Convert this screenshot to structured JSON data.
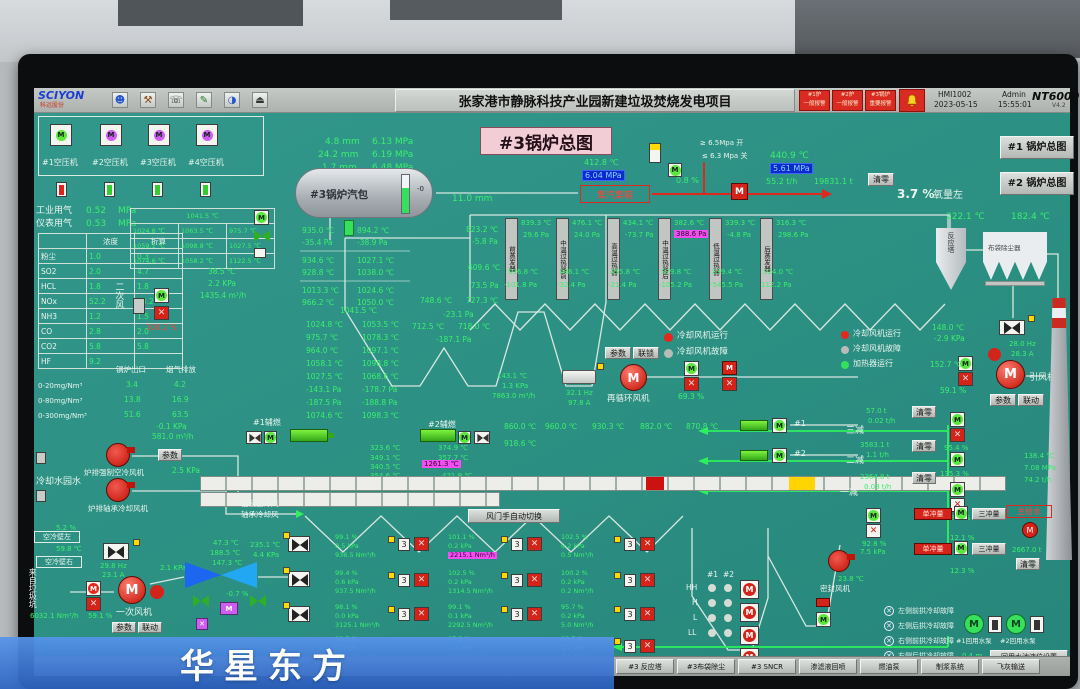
{
  "toolbar": {
    "logo": "SCIYON",
    "logo_sub": "科远股份",
    "title": "张家港市静脉科技产业园新建垃圾焚烧发电项目",
    "a1l1": "#1炉",
    "a1l2": "一般报警",
    "a2l1": "#2炉",
    "a2l2": "一般报警",
    "a3l1": "#3锅炉",
    "a3l2": "重要报警",
    "hmi": "HMI1002",
    "date": "2023-05-15",
    "user": "Admin",
    "time": "15:55:01",
    "brand": "NT6000",
    "ver": "V4.2"
  },
  "title_box": "#3锅炉总图",
  "nav": {
    "b1": "#1 锅炉总图",
    "b2": "#2 锅炉总图"
  },
  "compressors": {
    "labels": [
      "#1空压机",
      "#2空压机",
      "#3空压机",
      "#4空压机"
    ]
  },
  "gas": {
    "l1": "工业用气",
    "v1": "0.52",
    "u1": "MPa",
    "l2": "仪表用气",
    "v2": "0.53",
    "u2": "MPa"
  },
  "emis": {
    "h1": "浓度",
    "h2": "折算",
    "rows": [
      {
        "n": "粉尘",
        "a": "1.0",
        "b": "0.3"
      },
      {
        "n": "SO2",
        "a": "2.0",
        "b": "4.7"
      },
      {
        "n": "HCL",
        "a": "1.8",
        "b": "1.8"
      },
      {
        "n": "NOx",
        "a": "52.2",
        "b": "53.2"
      },
      {
        "n": "NH3",
        "a": "1.2",
        "b": "1.5"
      },
      {
        "n": "CO",
        "a": "2.8",
        "b": "2.0"
      },
      {
        "n": "CO2",
        "a": "5.8",
        "b": "5.8"
      },
      {
        "n": "HF",
        "a": "9.2",
        "b": ""
      }
    ]
  },
  "range": {
    "h1": "锅炉出口",
    "h2": "烟气排放",
    "rows": [
      {
        "n": "0-20mg/Nm³",
        "a": "3.4",
        "b": "4.2"
      },
      {
        "n": "0-80mg/Nm³",
        "a": "13.8",
        "b": "16.9"
      },
      {
        "n": "0-300mg/Nm³",
        "a": "51.6",
        "b": "63.5"
      }
    ]
  },
  "ftable": {
    "r0": "1041.5 ℃",
    "r1": [
      "1024.8 ℃",
      "1063.5 ℃",
      "975.7 ℃"
    ],
    "r2": [
      "1059.1 ℃",
      "1098.8 ℃",
      "1027.5 ℃"
    ],
    "r3": [
      "1074.6 ℃",
      "1058.2 ℃",
      "1122.5 ℃"
    ]
  },
  "sec_air": {
    "label": "二次风",
    "pct": "100.2 %",
    "t": "38.5 ℃",
    "p": "2.2 KPa",
    "f": "1435.4 m³/h"
  },
  "drum": {
    "label": "#3锅炉汽包",
    "tick": "-0",
    "level": "11.0 mm",
    "gaps": [
      "4.8 mm",
      "24.2 mm",
      "1.7 mm"
    ],
    "press": [
      "6.13 MPa",
      "6.19 MPa",
      "6.48 MPa"
    ]
  },
  "header": {
    "label": "集汽集箱",
    "t": "412.8 ℃",
    "p": "6.04 MPa",
    "open": "≥ 6.5Mpa 开",
    "close": "≤ 6.3 Mpa 关",
    "leak": "0.8 %"
  },
  "steam": {
    "t": "440.9 ℃",
    "p": "5.61 MPa",
    "f": "55.2 t/h",
    "total": "19831.1 t",
    "clear": "清零",
    "o2": "3.7 %",
    "o2l": "氧量左"
  },
  "flue_top": {
    "t1": "222.1 ℃",
    "t2": "182.4 ℃"
  },
  "walls": {
    "rows": [
      [
        "935.0 ℃",
        "894.2 ℃"
      ],
      [
        "-35.4 Pa",
        "-38.9 Pa"
      ],
      [
        "934.6 ℃",
        "1027.1 ℃"
      ],
      [
        "928.8 ℃",
        "1038.0 ℃"
      ],
      [
        "1013.3 ℃",
        "1024.6 ℃"
      ],
      [
        "966.2 ℃",
        "1050.0 ℃"
      ]
    ]
  },
  "cblock": {
    "head": "1041.5 ℃",
    "rows": [
      [
        "1024.8 ℃",
        "1053.5 ℃"
      ],
      [
        "975.7 ℃",
        "1078.3 ℃"
      ],
      [
        "964.0 ℃",
        "1097.1 ℃"
      ],
      [
        "1058.1 ℃",
        "1098.8 ℃"
      ],
      [
        "1027.5 ℃",
        "1068.6 ℃"
      ],
      [
        "-143.1 Pa",
        "-178.7 Pa"
      ],
      [
        "-187.5 Pa",
        "-188.8 Pa"
      ],
      [
        "1074.6 ℃",
        "1098.3 ℃"
      ]
    ]
  },
  "pass": {
    "in_t": "823.2 ℃",
    "in_p": "-5.8 Pa",
    "in_t2": "609.6 ℃",
    "in_p2": "-73.5 Pa",
    "m1": "748.6 ℃",
    "m2": "727.3 ℃",
    "m3": "-23.1 Pa",
    "m4": "712.5 ℃",
    "m5": "718.0 ℃",
    "m6": "-187.1 Pa"
  },
  "hx": {
    "strips": [
      "前蒸发器",
      "中温过热器前",
      "高温过热器",
      "中温过热器后",
      "低温过热器",
      "后蒸发器"
    ],
    "top": [
      {
        "t": "839.3 ℃",
        "p": "29.6 Pa"
      },
      {
        "t": "476.1 ℃",
        "p": "24.0 Pa"
      },
      {
        "t": "434.1 ℃",
        "p": "-73.7 Pa"
      },
      {
        "t": "382.6 ℃",
        "p": "388.6 Pa"
      },
      {
        "t": "339.3 ℃",
        "p": "-4.8 Pa"
      },
      {
        "t": "316.3 ℃",
        "p": "298.6 Pa"
      }
    ],
    "bot": [
      {
        "t": "536.8 ℃",
        "p": "-101.8 Pa"
      },
      {
        "t": "488.1 ℃",
        "p": "-32.4 Pa"
      },
      {
        "t": "455.8 ℃",
        "p": "-21.4 Pa"
      },
      {
        "t": "379.8 ℃",
        "p": "-105.2 Pa"
      },
      {
        "t": "339.4 ℃",
        "p": "-545.5 Pa"
      },
      {
        "t": "324.0 ℃",
        "p": "112.2 Pa"
      }
    ]
  },
  "recirc": {
    "hz": "32.1 Hz",
    "a": "97.8 A",
    "label": "再循环风机",
    "b1": "参数",
    "b2": "联锁",
    "pct": "69.3 %",
    "lg1": "冷却风机运行",
    "lg2": "冷却风机故障",
    "in1": "143.1 ℃",
    "in2": "1.3 KPa",
    "in3": "7863.0 m³/h"
  },
  "rlegend": {
    "l1": "冷却风机运行",
    "l2": "冷却风机故障",
    "l3": "加热器运行"
  },
  "coolfans": {
    "f1": "#1",
    "f2": "#2"
  },
  "idf": {
    "t1": "148.0 ℃",
    "p1": "-2.9 KPa",
    "hz": "28.0 Hz",
    "a": "28.3 A",
    "t2": "152.7 ℃",
    "pct": "59.1 %",
    "label": "引风机",
    "b1": "参数",
    "b2": "联动",
    "reactor": "反应塔",
    "baghouse": "布袋除尘器"
  },
  "furnace_out": [
    "960.0 ℃",
    "930.3 ℃",
    "882.0 ℃",
    "870.8 ℃"
  ],
  "grate": {
    "b1": "#1辅燃",
    "b2": "#2辅燃",
    "lt": [
      "323.6 ℃",
      "349.1 ℃",
      "340.5 ℃",
      "354.6 ℃"
    ],
    "rt": [
      "374.9 ℃",
      "357.7 ℃"
    ],
    "hl": "1261.3 ℃",
    "rb": "421.9 ℃",
    "t860": "860.0 ℃",
    "t918": "918.6 ℃",
    "air1": "强制空冷风",
    "air2": "轴承冷却风",
    "btn": "风门手自动切换"
  },
  "gfans": {
    "p1": "-0.1 KPa",
    "f1": "581.0 m³/h",
    "label1": "炉排强制空冷风机",
    "btn": "参数",
    "p2": "2.5 KPa",
    "label2": "炉排轴承冷却风机",
    "water": "冷却水园水",
    "pct": "5.2 %"
  },
  "paf": {
    "wall_l": "空冷壁左",
    "wl_t": "59.8 ℃",
    "wall_r": "空冷壁右",
    "pit": "来自垃圾坑",
    "hz": "29.8 Hz",
    "a": "23.1 A",
    "kpa": "2.1 KPa",
    "pct": "59.1 %",
    "label": "一次风机",
    "b1": "参数",
    "b2": "联动",
    "flow": "6032.1 Nm³/h"
  },
  "aph": {
    "t1": "47.3 ℃",
    "t2": "188.5 ℃",
    "t3": "147.3 ℃",
    "t4": "235.1 ℃",
    "p": "4.4 KPa",
    "pct": "-0.7 %"
  },
  "dgrid": {
    "rows": [
      [
        {
          "pct": "99.1 %",
          "kpa": "0.5 kPa",
          "flow": "936.5 Nm³/h"
        },
        {
          "pct": "101.1 %",
          "kpa": "0.2 kPa",
          "flow": "2215.1 Nm³/h"
        },
        {
          "pct": "102.5 %",
          "kpa": "0.2 kPa",
          "flow": "0.5 Nm³/h"
        }
      ],
      [
        {
          "pct": "99.4 %",
          "kpa": "0.6 kPa",
          "flow": "937.5 Nm³/h"
        },
        {
          "pct": "102.5 %",
          "kpa": "0.2 kPa",
          "flow": "1314.5 Nm³/h"
        },
        {
          "pct": "100.2 %",
          "kpa": "0.2 kPa",
          "flow": "0.2 Nm³/h"
        }
      ],
      [
        {
          "pct": "98.1 %",
          "kpa": "0.0 kPa",
          "flow": "3125.1 Nm³/h"
        },
        {
          "pct": "99.1 %",
          "kpa": "0.1 kPa",
          "flow": "2292.5 Nm³/h"
        },
        {
          "pct": "95.7 %",
          "kpa": "0.2 kPa",
          "flow": "5.0 Nm³/h"
        }
      ],
      [
        {
          "pct": "93.5 %",
          "kpa": "0.0 kPa",
          "flow": "916.5 Nm³/h"
        },
        {
          "pct": "97.5 %",
          "kpa": "0.3 kPa",
          "flow": "918.6 Nm³/h"
        },
        {
          "pct": "99.7 %",
          "kpa": "0.2 kPa",
          "flow": "0.1 Nm³/h"
        }
      ]
    ]
  },
  "hopper": {
    "c1": "#1",
    "c2": "#2",
    "levels": [
      "HH",
      "H",
      "L",
      "LL"
    ]
  },
  "seal": {
    "label": "密封风机",
    "t": "23.8 ℃"
  },
  "desup": {
    "rows": [
      {
        "label": "三减",
        "total": "57.0 t",
        "flow": "0.02 t/h",
        "pct": "95.4 %",
        "clear": "清零"
      },
      {
        "label": "二减",
        "total": "3583.1 t",
        "flow": "1.1 t/h",
        "pct": "135.3 %",
        "clear": "清零"
      },
      {
        "label": "一减",
        "total": "2364.8 t",
        "flow": "0.08 t/h",
        "pct": "28.1 %",
        "clear": "清零"
      }
    ],
    "fw": "主给水",
    "fw_t": "138.4 ℃",
    "fw_p": "7.08 MPa",
    "fw_f": "74.2 t/h",
    "vpct": "92.8 %",
    "s1": "单冲量",
    "s2": "三冲量",
    "sp1": "12.1 %",
    "sp2": "12.3 %",
    "total": "2667.0 t",
    "clear2": "清零",
    "kpa": "7.5 kPa"
  },
  "faults": [
    "左侧前拱冷却故障",
    "左侧后拱冷却故障",
    "右侧前拱冷却故障",
    "右侧后拱冷却故障"
  ],
  "pumps": {
    "p1": "#1回用水泵",
    "p2": "#2回用水泵",
    "btn": "回用水池液位设置",
    "level": "0.4 m"
  },
  "taskbar": [
    "#3 反应塔",
    "#3布袋除尘",
    "#3 SNCR",
    "渗滤液回喷",
    "燃油泵",
    "制浆系统",
    "飞灰输送"
  ],
  "watermark": "华星东方",
  "colors": {
    "teal": "#2b8f82",
    "green": "#3af06d",
    "red": "#e5271c",
    "blue_chip": "#0a2bd0",
    "magenta": "#f34df3",
    "pink": "#f2cdd6"
  }
}
